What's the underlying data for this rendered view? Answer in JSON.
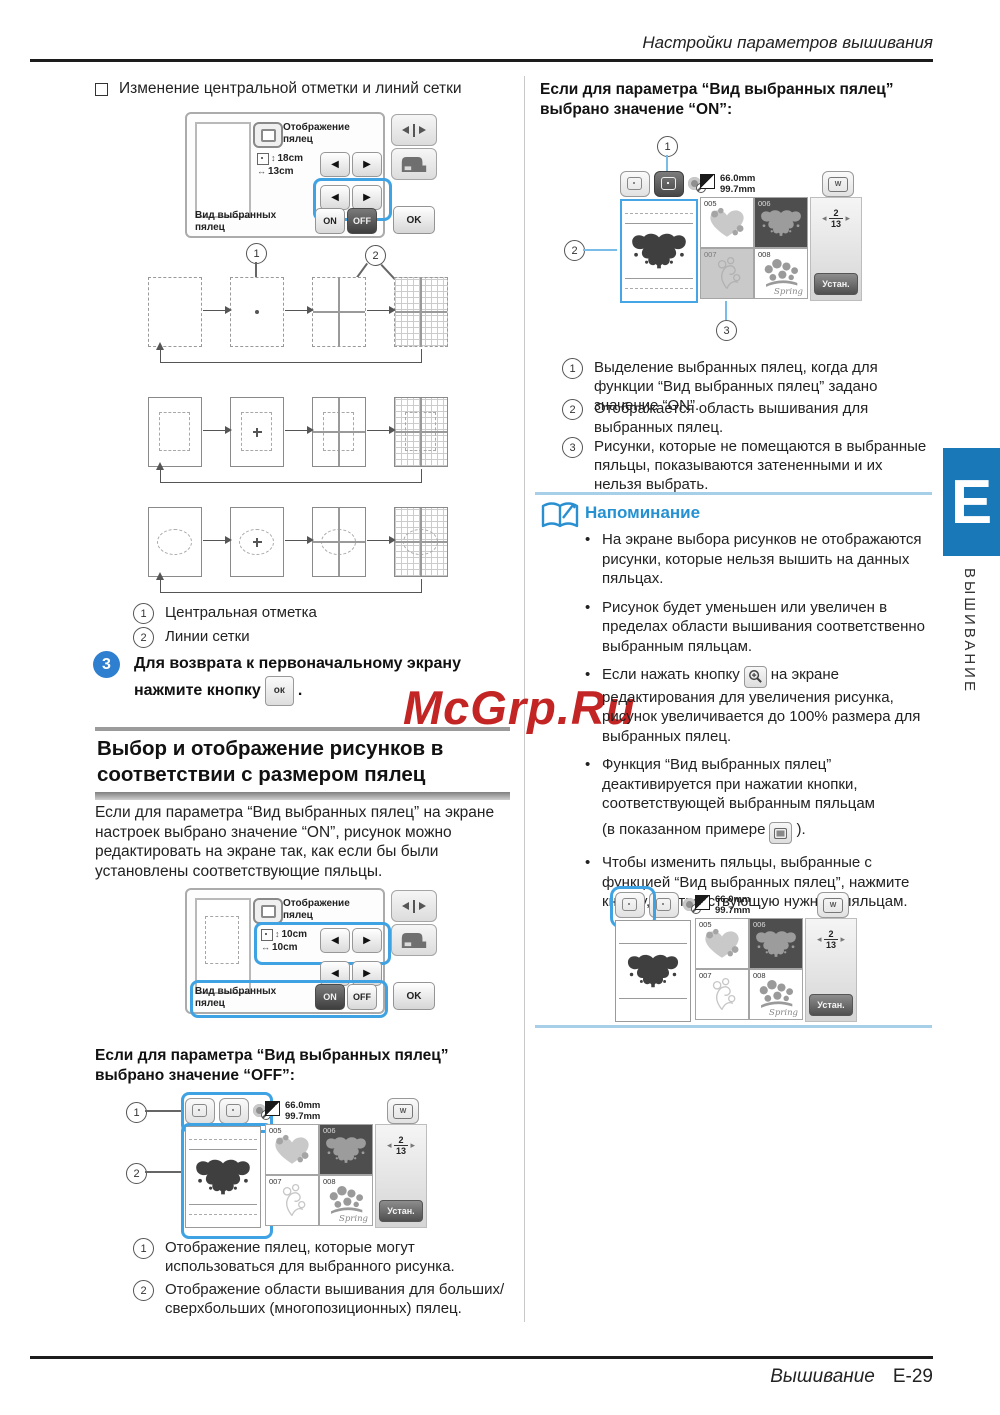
{
  "colors": {
    "accent_blue": "#3fa3e3",
    "note_blue": "#2591d2",
    "tab_blue": "#1878b8",
    "watermark_red": "#c32424",
    "selected_dark": "#4e4e4e"
  },
  "header": {
    "title": "Настройки параметров вышивания"
  },
  "footer": {
    "section": "Вышивание",
    "page": "E-29"
  },
  "tab": {
    "letter": "E",
    "vertical": "ВЫШИВАНИЕ"
  },
  "watermark": {
    "text": "McGrp.Ru"
  },
  "icons": {
    "arrow_left": "◀",
    "arrow_right": "▶",
    "nav_left": "◂",
    "nav_right": "▸",
    "size_v": "↕",
    "size_h": "↔"
  },
  "screen_common": {
    "display_label": "Отображение\nпялец",
    "view_label": "Вид выбранных\nпялец",
    "on": "ON",
    "off": "OFF",
    "ok": "OK"
  },
  "screen1": {
    "size_h": "18cm",
    "size_w": "13cm"
  },
  "screen2": {
    "size_h": "10cm",
    "size_w": "10cm"
  },
  "pattern_screen": {
    "size_w": "66.0mm",
    "size_h": "99.7mm",
    "tiles": [
      {
        "id": "005"
      },
      {
        "id": "006"
      },
      {
        "id": "007"
      },
      {
        "id": "008",
        "caption": "Spring"
      }
    ],
    "page_current": "2",
    "page_total": "13",
    "set_button": "Устан.",
    "hoop_w": "W"
  },
  "left": {
    "checkbox_heading": "Изменение центральной отметки и линий сетки",
    "diagram_callouts": {
      "c1": "1",
      "c2": "2"
    },
    "legend_marks": [
      {
        "n": "1",
        "text": "Центральная отметка"
      },
      {
        "n": "2",
        "text": "Линии сетки"
      }
    ],
    "step": {
      "n": "3",
      "text": "Для возврата к первоначальному экрану нажмите кнопку",
      "button": "ок",
      "after": "."
    },
    "section_title": "Выбор и отображение рисунков в\nсоответствии с размером пялец",
    "intro": "Если для параметра “Вид выбранных пялец” на экране настроек выбрано значение “ON”, рисунок можно редактировать на экране так, как если бы были установлены соответствующие пяльцы.",
    "off_heading": "Если для параметра “Вид выбранных пялец” выбрано значение “OFF”:",
    "off_callouts": {
      "c1": "1",
      "c2": "2"
    },
    "legend_off": [
      {
        "n": "1",
        "text": "Отображение пялец, которые могут использоваться для выбранного рисунка."
      },
      {
        "n": "2",
        "text": "Отображение области вышивания для больших/сверхбольших (многопозиционных) пялец."
      }
    ]
  },
  "right": {
    "on_heading": "Если для параметра “Вид выбранных пялец” выбрано значение “ON”:",
    "on_callouts": {
      "c1": "1",
      "c2": "2",
      "c3": "3"
    },
    "legend_on": [
      {
        "n": "1",
        "text": "Выделение выбранных пялец, когда для функции “Вид выбранных пялец” задано значение “ON”."
      },
      {
        "n": "2",
        "text": "Отображается область вышивания для выбранных пялец."
      },
      {
        "n": "3",
        "text": "Рисунки, которые не помещаются в выбранные пяльцы, показываются затененными и их нельзя выбрать."
      }
    ],
    "note": {
      "title": "Напоминание",
      "b1": "На экране выбора рисунков не отображаются рисунки, которые нельзя вышить на данных пяльцах.",
      "b2": "Рисунок будет уменьшен или увеличен в пределах области вышивания соответственно выбранным пяльцам.",
      "b3_before": "Если нажать кнопку",
      "b3_after": "на экране редактирования для увеличения рисунка, рисунок увеличивается до 100% размера для выбранных пялец.",
      "b4_line1": "Функция “Вид выбранных пялец” деактивируется при нажатии кнопки, соответствующей выбранным пяльцам",
      "b4_before_icon": "(в показанном примере",
      "b4_after_icon": ").",
      "b5": "Чтобы изменить пяльцы, выбранные с функцией “Вид выбранных пялец”, нажмите кнопку, соответствующую нужным пяльцам."
    }
  }
}
